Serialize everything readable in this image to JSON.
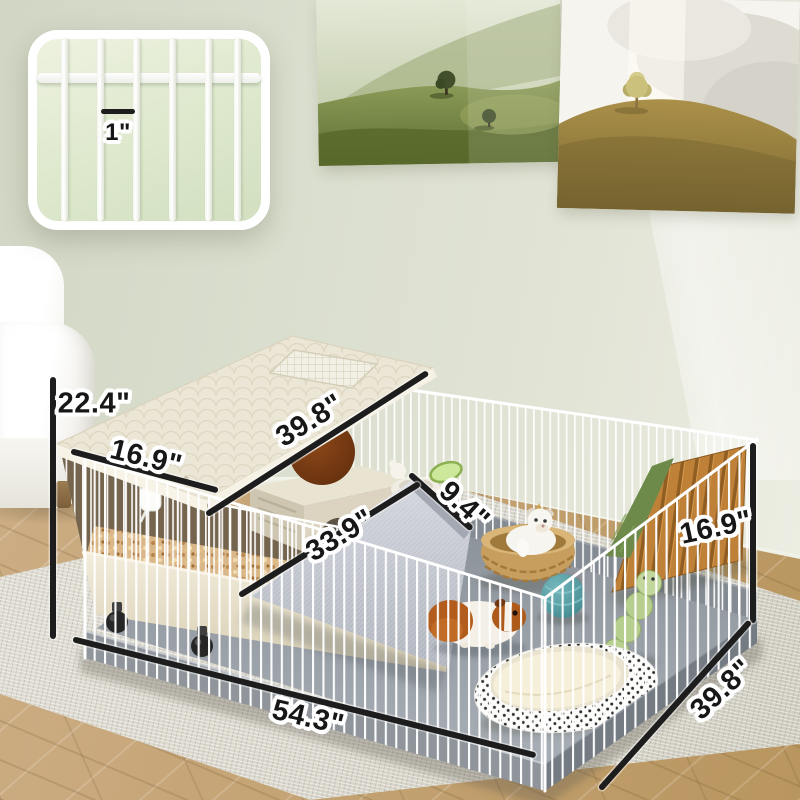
{
  "inset": {
    "bar_gap_label": "1\""
  },
  "dimensions": {
    "overall_height": "22.4\"",
    "cage_top_depth": "16.9\"",
    "cage_top_length": "39.8\"",
    "ramp_width": "9.4\"",
    "ramp_length": "33.9\"",
    "fence_height": "16.9\"",
    "playpen_length": "54.3\"",
    "playpen_depth": "39.8\""
  },
  "colors": {
    "wall": "#dde1d1",
    "wood_floor": "#c3a273",
    "rug": "#dbd8ce",
    "dimension_line": "#1d1d1d",
    "cage_body": "#ebe6d6",
    "pen_mat": "#99a0a8",
    "tray_gray": "#8f959b",
    "ball_teal": "#4f9aa0",
    "bridge_wood": "#bd7f37",
    "moss_green": "#6d8a4a",
    "basket_tan": "#c79e5e"
  }
}
